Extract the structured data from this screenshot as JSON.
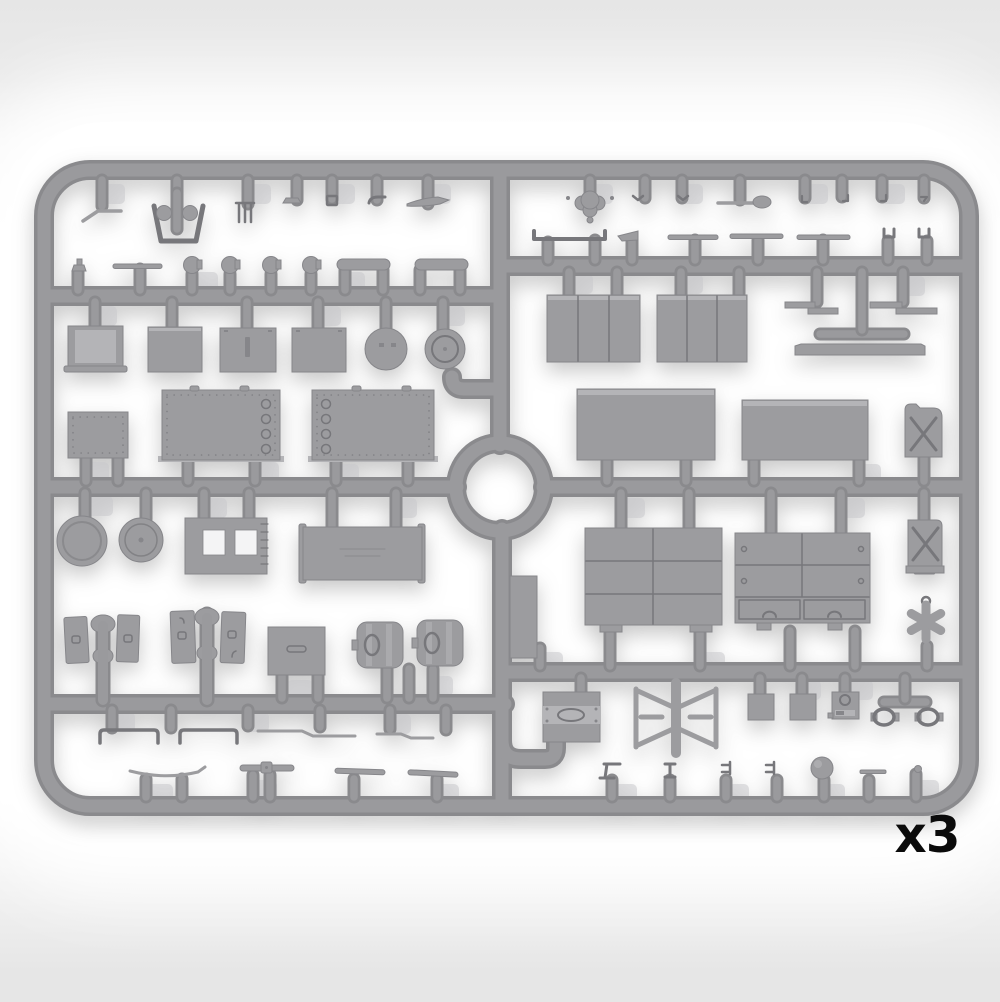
{
  "title": "Grey plastic model-kit sprue, included three times",
  "quantity_label": "x3",
  "colors": {
    "bg_edge": "#e6e6e6",
    "bg_mid": "#fdfdfd",
    "sprue": "#9a9a9d",
    "sprue_dark": "#8a8a8d",
    "sprue_light": "#aaaaad",
    "part": "#9c9c9f",
    "part_dark": "#86868a",
    "part_light": "#b4b4b7",
    "detail": "#77777b",
    "ghost": "#c9c9cc",
    "hole": "#f4f4f5",
    "label": "#0b0b0b"
  },
  "sprue": {
    "frame_shape": "rounded-rectangle runner frame with central circular runner",
    "material": "grey styrene",
    "sections": {
      "top_left_row": [
        "bent-rod",
        "bucket",
        "cross-clamp",
        "comb",
        "latch",
        "buckle",
        "hook",
        "knife"
      ],
      "left_small_row": [
        "cap-knob",
        "flat-bar",
        "round-knob",
        "round-knob",
        "round-knob",
        "round-knob",
        "round-bar",
        "round-bar"
      ],
      "left_crate_row": [
        "folding-table",
        "crate",
        "crate-with-hasp",
        "crate",
        "round-lid",
        "round-lid"
      ],
      "left_panel_row": [
        "riveted-panel-small",
        "riveted-panel",
        "riveted-panel"
      ],
      "left_mid_row": [
        "road-wheel",
        "hub-cap",
        "twin-window-frame",
        "side-panel"
      ],
      "left_door_row": [
        "door-pair-on-post",
        "door-pair-on-post",
        "stowage-box",
        "canister",
        "canister"
      ],
      "left_rod_rows": [
        "u-bracket",
        "u-bracket",
        "tow-rod",
        "tow-rod",
        "curved-rod",
        "linkage-bar",
        "flat-rod",
        "flat-rod"
      ],
      "top_right_row": [
        "wing-knob",
        "clip",
        "clip",
        "ladle",
        "hook",
        "hook",
        "hook",
        "hook"
      ],
      "right_slat_row": [
        "channel-bracket",
        "pointed-slat",
        "slat",
        "slat",
        "slat",
        "u-clamp",
        "u-clamp"
      ],
      "right_crate_row": [
        "planked-crate",
        "planked-crate",
        "step-bracket",
        "step-bracket",
        "runner-bar",
        "sill-bar"
      ],
      "right_tarp_row": [
        "tarpaulin-block",
        "tarpaulin-block",
        "jerry-can"
      ],
      "right_panel_row": [
        "paneled-door-grid",
        "drawer-cabinet",
        "jerry-can",
        "star-wheel"
      ],
      "right_small_row": [
        "stove-block",
        "trestle-frame",
        "stowage-box",
        "stowage-box",
        "radio-box",
        "clamp-ring",
        "clamp-ring"
      ],
      "right_bottom_row": [
        "angle-bracket",
        "i-bracket",
        "e-bracket",
        "e-bracket",
        "ball",
        "pin-bar",
        "rivet"
      ],
      "center": [
        "hatch-panel",
        "circular-runner",
        "j-runner"
      ]
    }
  }
}
